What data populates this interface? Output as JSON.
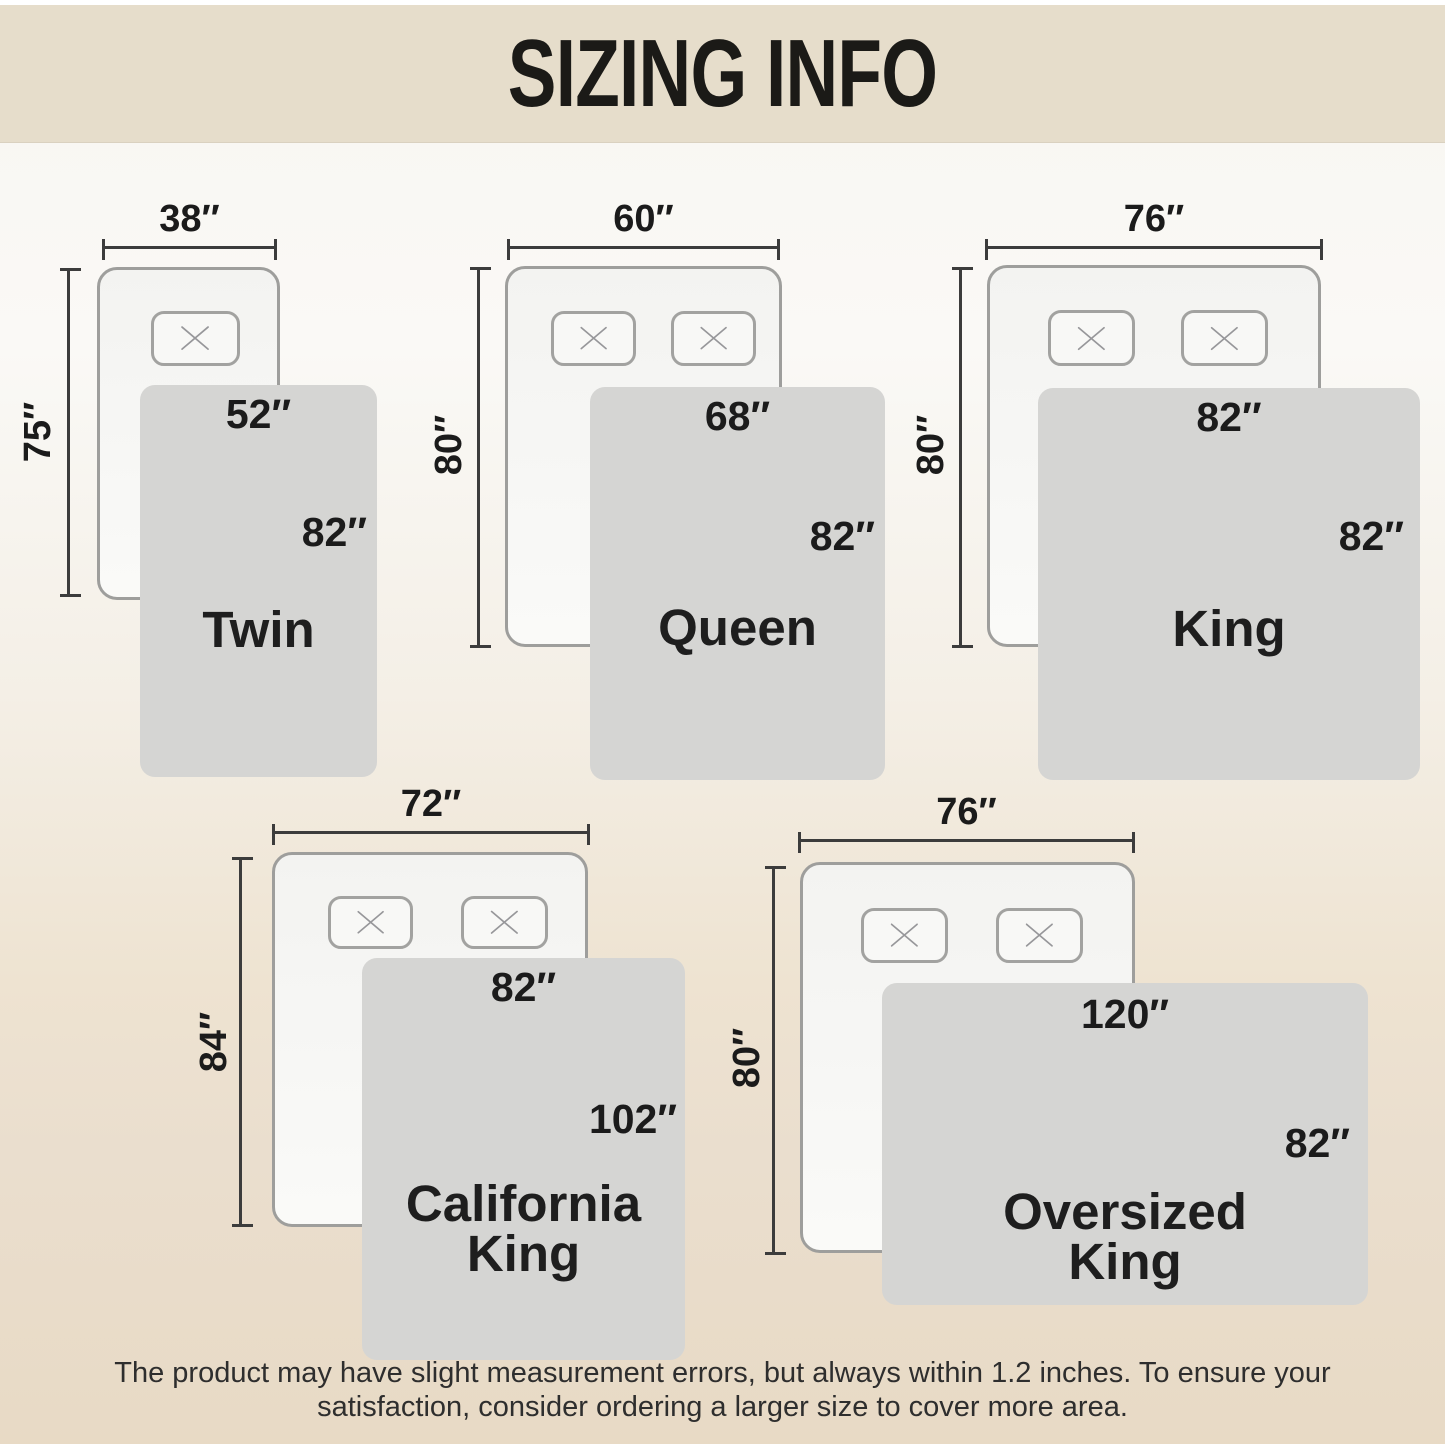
{
  "title": "SIZING INFO",
  "footer": {
    "line1": "The product may have slight measurement errors, but always within 1.2 inches. To ensure your",
    "line2": "satisfaction, consider ordering a larger size to cover more area."
  },
  "colors": {
    "header_bg": "#e6ddcb",
    "bg_top": "#f8f6f1",
    "bg_bottom": "#e8dac5",
    "mattress_fill": "#f6f6f4",
    "mattress_border": "#9e9e9c",
    "pillow_border": "#a2a2a0",
    "blanket_fill": "#d5d5d3",
    "dim_line": "#3c3c3c",
    "text_dark": "#1b1b1b"
  },
  "sizes": [
    {
      "id": "twin",
      "name_line1": "Twin",
      "name_line2": "",
      "mattress_width": "38″",
      "mattress_height": "75″",
      "blanket_width": "52″",
      "blanket_height": "82″",
      "pillow_count": 1
    },
    {
      "id": "queen",
      "name_line1": "Queen",
      "name_line2": "",
      "mattress_width": "60″",
      "mattress_height": "80″",
      "blanket_width": "68″",
      "blanket_height": "82″",
      "pillow_count": 2
    },
    {
      "id": "king",
      "name_line1": "King",
      "name_line2": "",
      "mattress_width": "76″",
      "mattress_height": "80″",
      "blanket_width": "82″",
      "blanket_height": "82″",
      "pillow_count": 2
    },
    {
      "id": "california-king",
      "name_line1": "California",
      "name_line2": "King",
      "mattress_width": "72″",
      "mattress_height": "84″",
      "blanket_width": "82″",
      "blanket_height": "102″",
      "pillow_count": 2
    },
    {
      "id": "oversized-king",
      "name_line1": "Oversized",
      "name_line2": "King",
      "mattress_width": "76″",
      "mattress_height": "80″",
      "blanket_width": "120″",
      "blanket_height": "82″",
      "pillow_count": 2
    }
  ]
}
